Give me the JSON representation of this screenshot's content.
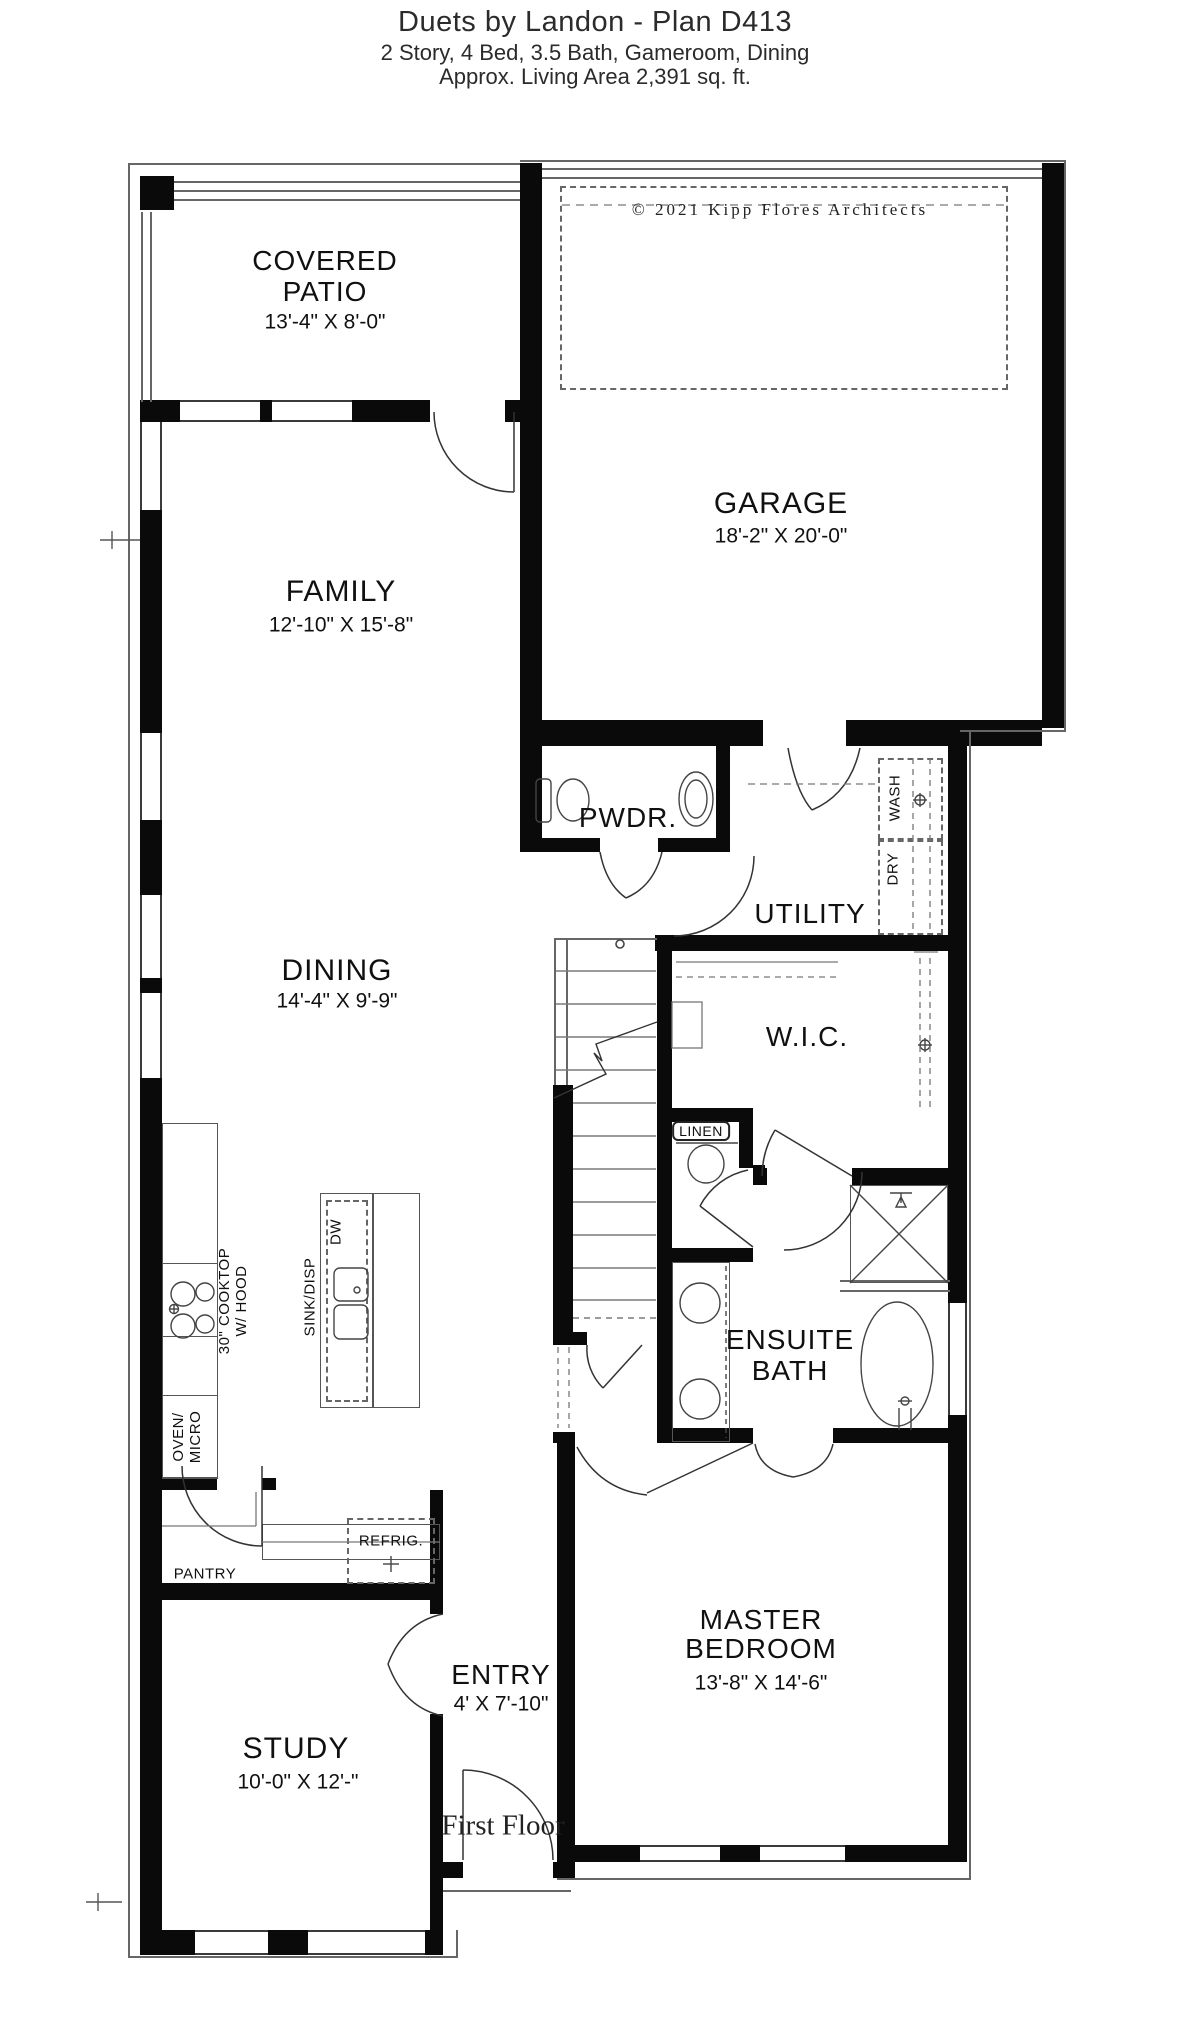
{
  "title": "Duets by Landon - Plan D413",
  "subtitle": "2 Story, 4 Bed, 3.5 Bath, Gameroom, Dining",
  "subtitle2": "Approx. Living Area 2,391 sq. ft.",
  "copyright": "© 2021 Kipp Flores Architects",
  "floor_label": "First Floor",
  "rooms": {
    "covered_patio": {
      "name1": "COVERED",
      "name2": "PATIO",
      "dims": "13'-4\" X 8'-0\""
    },
    "garage": {
      "name": "GARAGE",
      "dims": "18'-2\" X 20'-0\""
    },
    "family": {
      "name": "FAMILY",
      "dims": "12'-10\" X 15'-8\""
    },
    "dining": {
      "name": "DINING",
      "dims": "14'-4\" X 9'-9\""
    },
    "powder": {
      "name": "PWDR."
    },
    "utility": {
      "name": "UTILITY"
    },
    "wic": {
      "name": "W.I.C."
    },
    "ensuite_bath": {
      "name1": "ENSUITE",
      "name2": "BATH"
    },
    "master": {
      "name1": "MASTER",
      "name2": "BEDROOM",
      "dims": "13'-8\" X 14'-6\""
    },
    "entry": {
      "name": "ENTRY",
      "dims": "4' X 7'-10\""
    },
    "study": {
      "name": "STUDY",
      "dims": "10'-0\" X 12'-\""
    }
  },
  "fixtures": {
    "linen": "LINEN",
    "pantry": "PANTRY",
    "refrig": "REFRIG.",
    "wash": "WASH",
    "dry": "DRY",
    "dw": "DW",
    "sink_disp": "SINK/DISP",
    "cooktop_line1": "30\" COOKTOP",
    "cooktop_line2": "W/ HOOD",
    "oven_line1": "OVEN/",
    "oven_line2": "MICRO"
  },
  "colors": {
    "wall": "#0a0a0a",
    "line": "#555555",
    "text": "#111111"
  }
}
